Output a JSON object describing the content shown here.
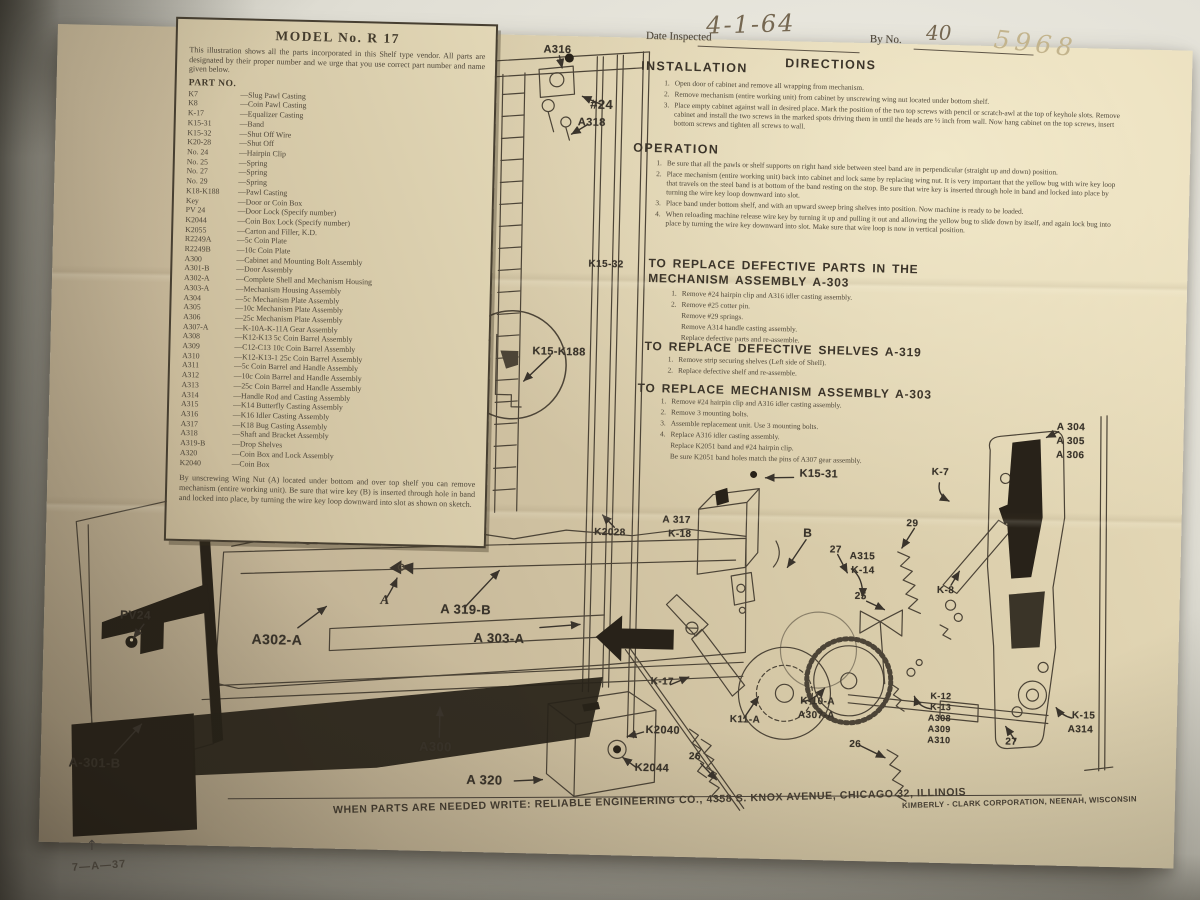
{
  "colors": {
    "paper": "#d7caa8",
    "ink": "#4d4537",
    "black": "#282219"
  },
  "sheet": {
    "panel": {
      "title": "MODEL No. R 17",
      "intro": "This illustration shows all the parts incorporated in this Shelf type vendor. All parts are designated by their proper number and we urge that you use correct part number and name given below.",
      "part_no_header": "PART NO.",
      "parts": [
        {
          "no": "K7",
          "desc": "—Slug Pawl Casting"
        },
        {
          "no": "K8",
          "desc": "—Coin Pawl Casting"
        },
        {
          "no": "K-17",
          "desc": "—Equalizer Casting"
        },
        {
          "no": "K15-31",
          "desc": "—Band"
        },
        {
          "no": "K15-32",
          "desc": "—Shut Off Wire"
        },
        {
          "no": "K20-28",
          "desc": "—Shut Off"
        },
        {
          "no": "No. 24",
          "desc": "—Hairpin Clip"
        },
        {
          "no": "No. 25",
          "desc": "—Spring"
        },
        {
          "no": "No. 27",
          "desc": "—Spring"
        },
        {
          "no": "No. 29",
          "desc": "—Spring"
        },
        {
          "no": "K18-K188",
          "desc": "—Pawl Casting"
        },
        {
          "no": "Key",
          "desc": "—Door or Coin Box"
        },
        {
          "no": "PV 24",
          "desc": "—Door Lock (Specify number)"
        },
        {
          "no": "K2044",
          "desc": "—Coin Box Lock (Specify number)"
        },
        {
          "no": "K2055",
          "desc": "—Carton and Filler, K.D."
        },
        {
          "no": "R2249A",
          "desc": "—5c Coin Plate"
        },
        {
          "no": "R2249B",
          "desc": "—10c Coin Plate"
        },
        {
          "no": "A300",
          "desc": "—Cabinet and Mounting Bolt Assembly"
        },
        {
          "no": "A301-B",
          "desc": "—Door Assembly"
        },
        {
          "no": "A302-A",
          "desc": "—Complete Shell and Mechanism Housing"
        },
        {
          "no": "A303-A",
          "desc": "—Mechanism Housing Assembly"
        },
        {
          "no": "A304",
          "desc": "—5c Mechanism Plate Assembly"
        },
        {
          "no": "A305",
          "desc": "—10c Mechanism Plate Assembly"
        },
        {
          "no": "A306",
          "desc": "—25c Mechanism Plate Assembly"
        },
        {
          "no": "A307-A",
          "desc": "—K-10A-K-11A Gear Assembly"
        },
        {
          "no": "A308",
          "desc": "—K12-K13 5c Coin Barrel Assembly"
        },
        {
          "no": "A309",
          "desc": "—C12-C13 10c Coin Barrel Assembly"
        },
        {
          "no": "A310",
          "desc": "—K12-K13-1 25c Coin Barrel Assembly"
        },
        {
          "no": "A311",
          "desc": "—5c Coin Barrel and Handle Assembly"
        },
        {
          "no": "A312",
          "desc": "—10c Coin Barrel and Handle Assembly"
        },
        {
          "no": "A313",
          "desc": "—25c Coin Barrel and Handle Assembly"
        },
        {
          "no": "A314",
          "desc": "—Handle Rod and Casting Assembly"
        },
        {
          "no": "A315",
          "desc": "—K14 Butterfly Casting Assembly"
        },
        {
          "no": "A316",
          "desc": "—K16 Idler Casting Assembly"
        },
        {
          "no": "A317",
          "desc": "—K18 Bug Casting Assembly"
        },
        {
          "no": "A318",
          "desc": "—Shaft and Bracket Assembly"
        },
        {
          "no": "A319-B",
          "desc": "—Drop Shelves"
        },
        {
          "no": "A320",
          "desc": "—Coin Box and Lock Assembly"
        },
        {
          "no": "K2040",
          "desc": "—Coin Box"
        }
      ],
      "footnote": "By unscrewing Wing Nut (A) located under bottom and over top shelf you can remove mechanism (entire working unit). Be sure that wire key (B) is inserted through hole in band and locked into place, by turning the wire key loop downward into slot as shown on sketch."
    },
    "inspection": {
      "date_label": "Date Inspected",
      "date_value": "4-1-64",
      "by_label": "By No.",
      "by_value": "40",
      "stock_code": "5968"
    },
    "directions_title": "DIRECTIONS",
    "installation": {
      "title": "INSTALLATION",
      "steps": [
        {
          "n": "1.",
          "t": "Open door of cabinet and remove all wrapping from mechanism."
        },
        {
          "n": "2.",
          "t": "Remove mechanism (entire working unit) from cabinet by unscrewing wing nut located under bottom shelf."
        },
        {
          "n": "3.",
          "t": "Place empty cabinet against wall in desired place. Mark the position of the two top screws with pencil or scratch-awl at the top of keyhole slots. Remove cabinet and install the two screws in the marked spots driving them in until the heads are ½ inch from wall. Now hang cabinet on the top screws, insert bottom screws and tighten all screws to wall."
        }
      ]
    },
    "operation": {
      "title": "OPERATION",
      "steps": [
        {
          "n": "1.",
          "t": "Be sure that all the pawls or shelf supports on right hand side between steel band are in perpendicular (straight up and down) position."
        },
        {
          "n": "2.",
          "t": "Place mechanism (entire working unit) back into cabinet and lock same by replacing wing nut. It is very important that the yellow bug with wire key loop that travels on the steel band is at bottom of the band resting on the stop. Be sure that wire key is inserted through hole in band and locked into place by turning the wire key loop downward into slot."
        },
        {
          "n": "3.",
          "t": "Place band under bottom shelf, and with an upward sweep bring shelves into position. Now machine is ready to be loaded."
        },
        {
          "n": "4.",
          "t": "When reloading machine release wire key by turning it up and pulling it out and allowing the yellow bug to slide down by itself, and again lock bug into place by turning the wire key downward into slot. Make sure that wire loop is now in vertical position."
        }
      ]
    },
    "replace_parts": {
      "title1": "TO REPLACE DEFECTIVE PARTS IN THE",
      "title2": "MECHANISM ASSEMBLY A-303",
      "steps": [
        {
          "n": "1.",
          "t": "Remove #24 hairpin clip and A316 idler casting assembly."
        },
        {
          "n": "2.",
          "t": "Remove #25 cotter pin."
        },
        {
          "n": "",
          "t": "Remove #29 springs."
        },
        {
          "n": "",
          "t": "Remove A314 handle casting assembly."
        },
        {
          "n": "",
          "t": "Replace defective parts and re-assemble."
        }
      ]
    },
    "replace_shelves": {
      "title": "TO REPLACE DEFECTIVE SHELVES A-319",
      "steps": [
        {
          "n": "1.",
          "t": "Remove strip securing shelves (Left side of Shell)."
        },
        {
          "n": "2.",
          "t": "Replace defective shelf and re-assemble."
        }
      ]
    },
    "replace_mechanism": {
      "title": "TO REPLACE MECHANISM ASSEMBLY A-303",
      "steps": [
        {
          "n": "1.",
          "t": "Remove #24 hairpin clip and A316 idler casting assembly."
        },
        {
          "n": "2.",
          "t": "Remove 3 mounting bolts."
        },
        {
          "n": "3.",
          "t": "Assemble replacement unit. Use 3 mounting bolts."
        },
        {
          "n": "4.",
          "t": "Replace A316 idler casting assembly."
        },
        {
          "n": "",
          "t": "Replace K2051 band and #24 hairpin clip."
        },
        {
          "n": "",
          "t": "Be sure K2051 band holes match the pins of A307 gear assembly."
        }
      ]
    },
    "footer": {
      "line": "WHEN PARTS ARE NEEDED WRITE: RELIABLE ENGINEERING CO., 4358 S. KNOX AVENUE, CHICAGO 32, ILLINOIS",
      "maker": "KIMBERLY - CLARK CORPORATION, NEENAH, WISCONSIN"
    },
    "corner_code": "7—A—37",
    "corner_arrow": "↑"
  },
  "labels": [
    "A316",
    "#24",
    "A318",
    "K15-32",
    "K15-K188",
    "K2028",
    "A 317",
    "K-18",
    "PV24",
    "A-301-B",
    "A302-A",
    "A",
    "A 319-B",
    "A 303-A",
    "A300",
    "A 320",
    "K2040",
    "K2044",
    "26",
    "K15-31",
    "K-7",
    "29",
    "B",
    "27",
    "A315",
    "K-14",
    "25",
    "K-8",
    "A 304",
    "A 305",
    "A 306",
    "K-17",
    "K11-A",
    "K-10-A",
    "A307-A",
    "26",
    "K-12",
    "K-13",
    "A308",
    "A309",
    "A310",
    "27",
    "K-15",
    "A314"
  ]
}
